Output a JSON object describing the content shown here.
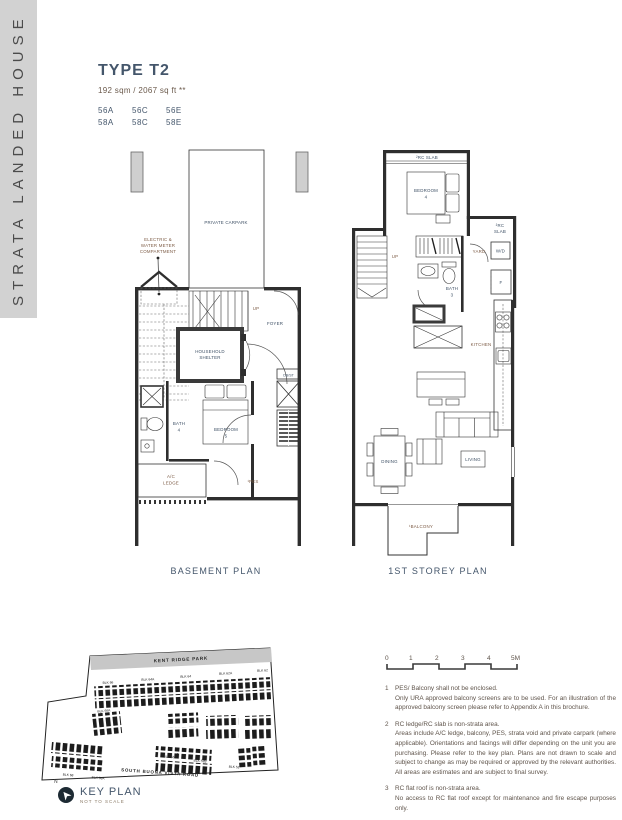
{
  "sidebar": {
    "title": "STRATA LANDED HOUSE"
  },
  "header": {
    "type_label": "TYPE T2",
    "area": "192 sqm / 2067 sq ft **",
    "units": [
      "56A",
      "56C",
      "56E",
      "58A",
      "58C",
      "58E"
    ]
  },
  "basement": {
    "caption": "BASEMENT PLAN",
    "carpark": "PRIVATE CARPARK",
    "meter1": "ELECTRIC &",
    "meter2": "WATER METER",
    "meter3": "COMPARTMENT",
    "up": "UP",
    "foyer": "FOYER",
    "shelter1": "HOUSEHOLD",
    "shelter2": "SHELTER",
    "dbst": "DB/ST",
    "bedroom1": "BEDROOM",
    "bedroom2": "5",
    "bath1": "BATH",
    "bath2": "4",
    "acledge1": "A/C",
    "acledge2": "LEDGE",
    "pes": "¹PES"
  },
  "storey": {
    "caption": "1ST STOREY PLAN",
    "rcslab_top": "²RC SLAB",
    "rcslab_r1": "²RC",
    "rcslab_r2": "SLAB",
    "bedroom1": "BEDROOM",
    "bedroom2": "4",
    "up": "UP",
    "yard": "YARD",
    "wd": "W/D",
    "bath1": "BATH",
    "bath2": "3",
    "fridge": "F",
    "kitchen": "KITCHEN",
    "dining": "DINING",
    "living": "LIVING",
    "balcony": "¹BALCONY"
  },
  "keyplan": {
    "title": "KEY PLAN",
    "subtitle": "NOT TO SCALE",
    "north": "N",
    "park": "KENT RIDGE PARK",
    "road": "SOUTH BUONA VISTA ROAD",
    "blocks_top": [
      "BLK 66",
      "BLK 64A",
      "BLK 64",
      "BLK 62A",
      "BLK 62"
    ],
    "blocks_other": [
      "BLK 66A",
      "BLK 68",
      "BLK 68A",
      "BLK 56B",
      "BLK 52B",
      "BLK 52"
    ]
  },
  "notes": {
    "scale_ticks": [
      "0",
      "1",
      "2",
      "3",
      "4",
      "5M"
    ],
    "n1_num": "1",
    "n1_a": "PES/ Balcony shall not be enclosed.",
    "n1_b": "Only URA approved balcony screens are to be used. For an illustration of the approved balcony screen please refer to Appendix A in this brochure.",
    "n2_num": "2",
    "n2_a": "RC ledge/RC slab is non-strata area.",
    "n2_b": "Areas include A/C ledge, balcony, PES, strata void and private carpark (where applicable). Orientations and facings will differ depending on the unit you are purchasing. Please refer to the key plan. Plans are not drawn to scale and subject to change as may be required or approved by the relevant authorities. All areas are estimates and are subject to final survey.",
    "n3_num": "3",
    "n3_a": "RC flat roof is non-strata area.",
    "n3_b": "No access to RC flat roof except for maintenance and fire escape purposes only."
  }
}
